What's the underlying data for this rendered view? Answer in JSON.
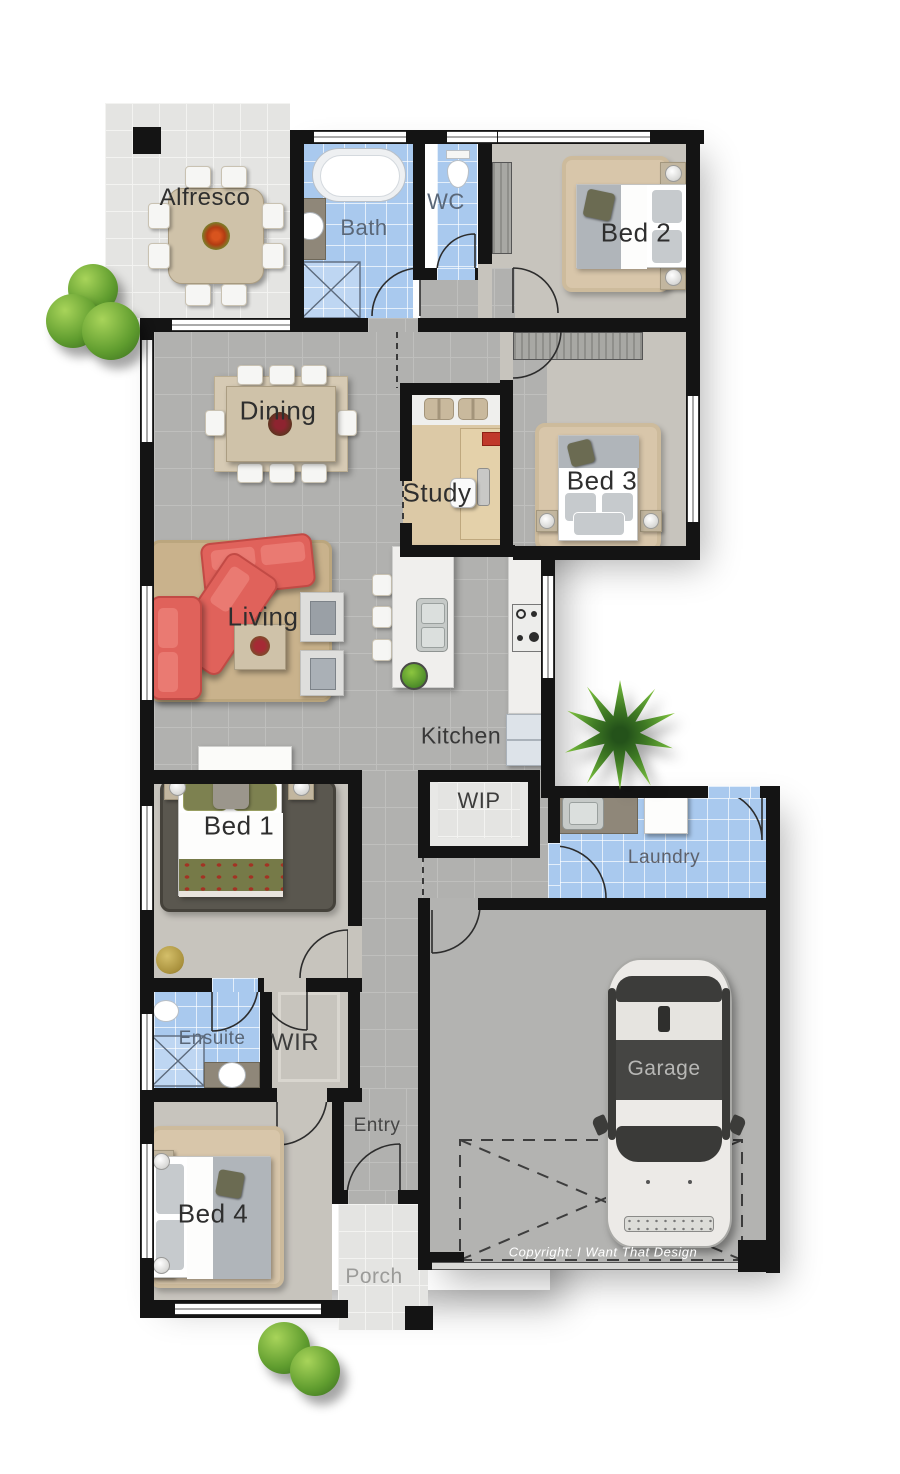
{
  "plan": {
    "rooms": {
      "alfresco": {
        "label": "Alfresco"
      },
      "bath": {
        "label": "Bath"
      },
      "wc": {
        "label": "WC"
      },
      "bed2": {
        "label": "Bed 2"
      },
      "dining": {
        "label": "Dining"
      },
      "study": {
        "label": "Study"
      },
      "bed3": {
        "label": "Bed 3"
      },
      "living": {
        "label": "Living"
      },
      "kitchen": {
        "label": "Kitchen"
      },
      "wip": {
        "label": "WIP"
      },
      "laundry": {
        "label": "Laundry"
      },
      "bed1": {
        "label": "Bed 1"
      },
      "ensuite": {
        "label": "Ensuite"
      },
      "wir": {
        "label": "WIR"
      },
      "entry": {
        "label": "Entry"
      },
      "garage": {
        "label": "Garage"
      },
      "bed4": {
        "label": "Bed 4"
      },
      "porch": {
        "label": "Porch"
      }
    },
    "copyright": "Copyright: I Want That Design",
    "colors": {
      "wall": "#141414",
      "floor": "#b1b1af",
      "floor_line": "#bfbfbd",
      "carpet": "#c7c4bd",
      "tile_blue": "#a9c9ee",
      "outdoor": "#e4e4e2",
      "rug_tan": "#d8c6aa",
      "rug_living": "#c9b28c",
      "sofa_red": "#e0625b",
      "bench_white": "#f0efed",
      "wood": "#cfc2a9",
      "label_dark": "#2e2e2e",
      "label_light": "#b7b7b5"
    }
  }
}
